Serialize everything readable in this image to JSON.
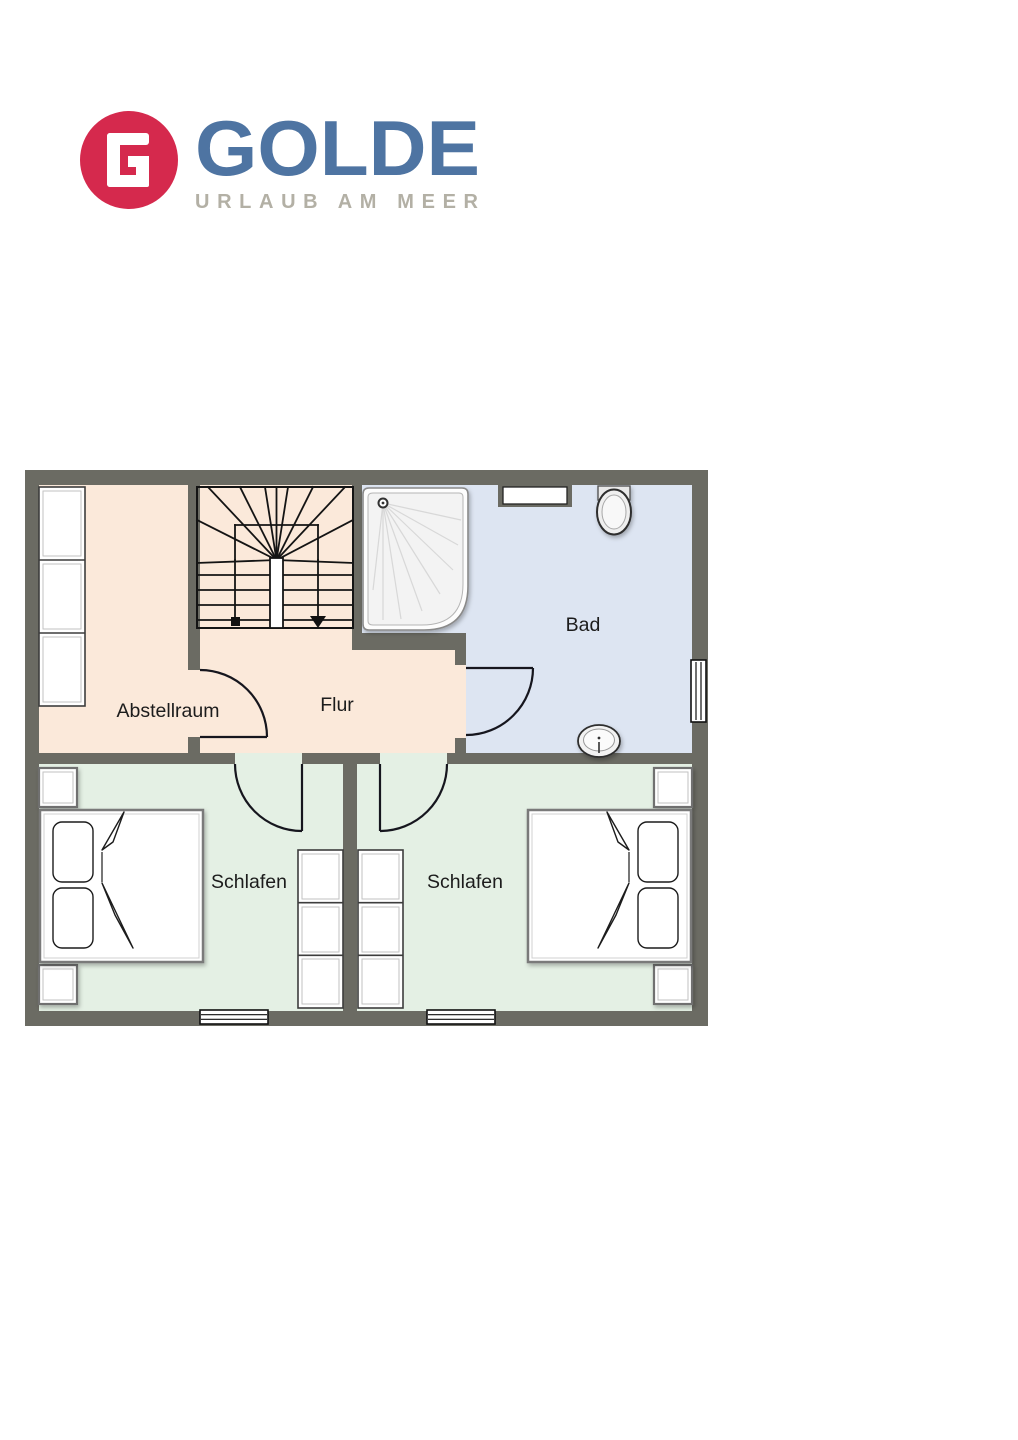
{
  "brand": {
    "initial": "G",
    "name": "GOLDE",
    "tagline": "URLAUB AM MEER",
    "circle_color": "#d5294d",
    "name_color": "#4e74a2",
    "tagline_color": "#b3b0a5"
  },
  "floorplan": {
    "wall_color": "#6b6b63",
    "label_color": "#1c1c1c",
    "rooms": [
      {
        "id": "abstellraum",
        "label": "Abstellraum",
        "floor_color": "#fbe9da"
      },
      {
        "id": "flur",
        "label": "Flur",
        "floor_color": "#fbe9da"
      },
      {
        "id": "bad",
        "label": "Bad",
        "floor_color": "#dde5f2"
      },
      {
        "id": "schlafen-links",
        "label": "Schlafen",
        "floor_color": "#e4f0e4"
      },
      {
        "id": "schlafen-rechts",
        "label": "Schlafen",
        "floor_color": "#e4f0e4"
      }
    ],
    "fixtures": [
      "staircase-with-winders",
      "shower",
      "toilet",
      "sink",
      "shelf-unit-3-cells",
      "double-bed-left",
      "double-bed-right",
      "wardrobe-3-cells-left-bedroom",
      "wardrobe-3-cells-right-bedroom",
      "nightstand-x4"
    ],
    "window_count": 5,
    "door_count": 4
  }
}
